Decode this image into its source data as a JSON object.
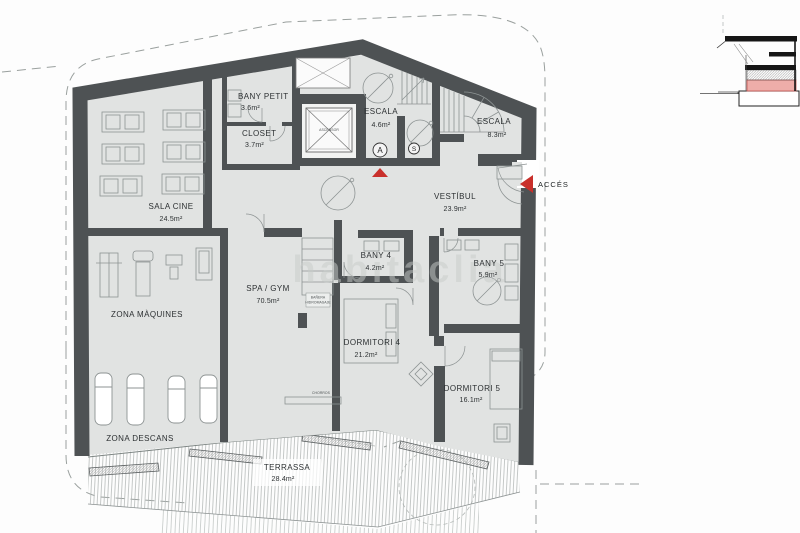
{
  "plan": {
    "watermark": "habitaclia",
    "rooms": [
      {
        "id": "bany-petit",
        "name": "BANY PETIT",
        "area": "3.6m²"
      },
      {
        "id": "closet",
        "name": "CLOSET",
        "area": "3.7m²"
      },
      {
        "id": "escala-a",
        "name": "ESCALA",
        "area": "4.6m²"
      },
      {
        "id": "escala-b",
        "name": "ESCALA",
        "area": "8.3m²"
      },
      {
        "id": "vestibul",
        "name": "VESTÍBUL",
        "area": "23.9m²"
      },
      {
        "id": "sala-cine",
        "name": "SALA CINE",
        "area": "24.5m²"
      },
      {
        "id": "zona-maquines",
        "name": "ZONA MÀQUINES",
        "area": ""
      },
      {
        "id": "spa-gym",
        "name": "SPA / GYM",
        "area": "70.5m²"
      },
      {
        "id": "bany-4",
        "name": "BANY 4",
        "area": "4.2m²"
      },
      {
        "id": "bany-5",
        "name": "BANY 5",
        "area": "5.9m²"
      },
      {
        "id": "dormitori-4",
        "name": "DORMITORI 4",
        "area": "21.2m²"
      },
      {
        "id": "dormitori-5",
        "name": "DORMITORI 5",
        "area": "16.1m²"
      },
      {
        "id": "zona-descans",
        "name": "ZONA DESCANS",
        "area": ""
      },
      {
        "id": "terrassa",
        "name": "TERRASSA",
        "area": "28.4m²"
      }
    ],
    "labels": {
      "acces": "ACCÉS",
      "stair_a": "A",
      "stair_s": "S",
      "ascensor": "ASCENSOR",
      "banera1": "BAÑERA",
      "banera2": "HIDROMASAJE",
      "chorros": "CHORROS"
    },
    "colors": {
      "wall": "#4e5254",
      "floor": "#e1e3e2",
      "accent_red": "#c9302b",
      "section_pink": "#eeada9",
      "dash": "#9aa09e"
    }
  }
}
